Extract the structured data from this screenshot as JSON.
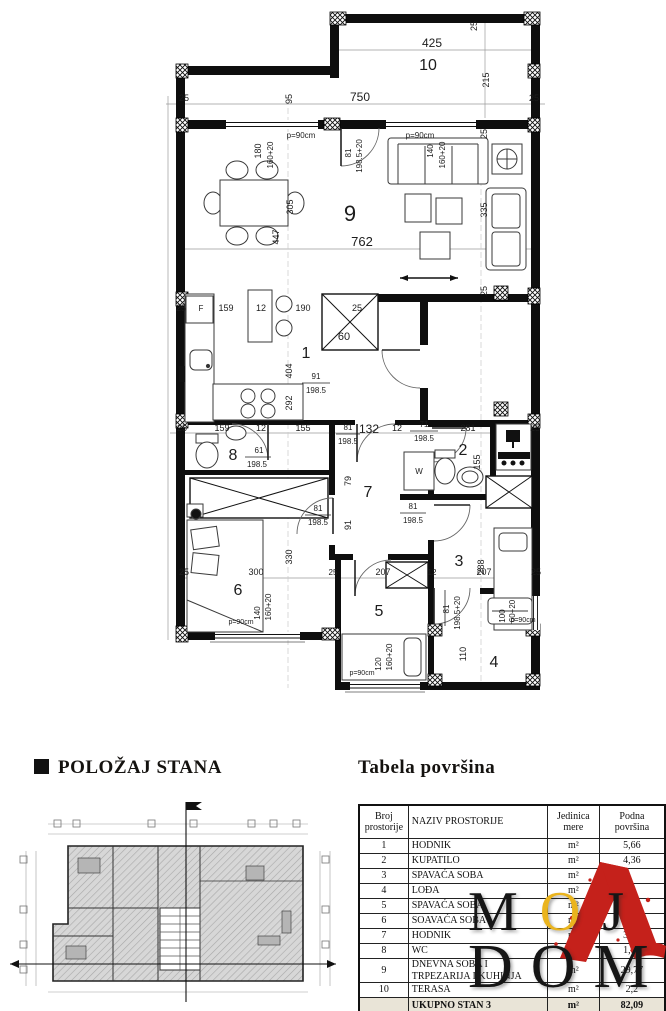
{
  "plan": {
    "room_numbers": {
      "r1": "1",
      "r2": "2",
      "r3": "3",
      "r4": "4",
      "r5": "5",
      "r6": "6",
      "r7": "7",
      "r8": "8",
      "r9": "9",
      "r10": "10"
    },
    "dims": {
      "d425": "425",
      "d215": "215",
      "d750": "750",
      "d95": "95",
      "d25": "25",
      "d762": "762",
      "d335": "335",
      "d305": "305",
      "d447": "447",
      "d180": "180",
      "d160p20": "160+20",
      "p90": "p=90cm",
      "d81": "81",
      "d1985": "198.5",
      "d1985p20": "198.5+20",
      "d140": "140",
      "d159": "159",
      "d12": "12",
      "d190": "190",
      "d60": "60",
      "d91": "91",
      "d292": "292",
      "d404": "404",
      "d155": "155",
      "d132": "132",
      "d71": "71",
      "d281": "281",
      "d61": "61",
      "d79": "79",
      "d330": "330",
      "d300": "300",
      "d288": "288",
      "d207": "207",
      "d110": "110",
      "d120": "120",
      "d100": "100",
      "d60p20": "60+20"
    },
    "letters": {
      "fridge": "F",
      "washer": "W"
    }
  },
  "position_section": {
    "title": "POLOŽAJ STANA"
  },
  "table_section": {
    "title": "Tabela površina",
    "headers": {
      "col1": "Broj prostorije",
      "col2": "NAZIV PROSTORIJE",
      "col3": "Jedinica mere",
      "col4": "Podna površina"
    },
    "rows": [
      {
        "num": "1",
        "name": "HODNIK",
        "unit": "m²",
        "area": "5,66"
      },
      {
        "num": "2",
        "name": "KUPATILO",
        "unit": "m²",
        "area": "4,36"
      },
      {
        "num": "3",
        "name": "SPAVAĆA SOBA",
        "unit": "m²",
        "area": ""
      },
      {
        "num": "4",
        "name": "LOĐA",
        "unit": "m²",
        "area": "2,"
      },
      {
        "num": "5",
        "name": "SPAVAĆA SOBA",
        "unit": "m²",
        "area": "6,01"
      },
      {
        "num": "6",
        "name": "SOAVAĆA SOBA",
        "unit": "m²",
        "area": "9,89"
      },
      {
        "num": "7",
        "name": "HODNIK",
        "unit": "m²",
        "area": "3,59"
      },
      {
        "num": "8",
        "name": "WC",
        "unit": "m²",
        "area": "1,74"
      },
      {
        "num": "9",
        "name": "DNEVNA SOBA I TRPEZARIJA I KUHINJA",
        "unit": "m²",
        "area": "29,77"
      },
      {
        "num": "10",
        "name": "TERASA",
        "unit": "m²",
        "area": "2,2"
      }
    ],
    "total": {
      "num": "",
      "label": "UKUPNO STAN 3",
      "unit": "m²",
      "value": "82,09"
    }
  },
  "logo": {
    "line1_m": "M",
    "line1_o": "O",
    "line1_j": "J",
    "line2": "DOM"
  }
}
